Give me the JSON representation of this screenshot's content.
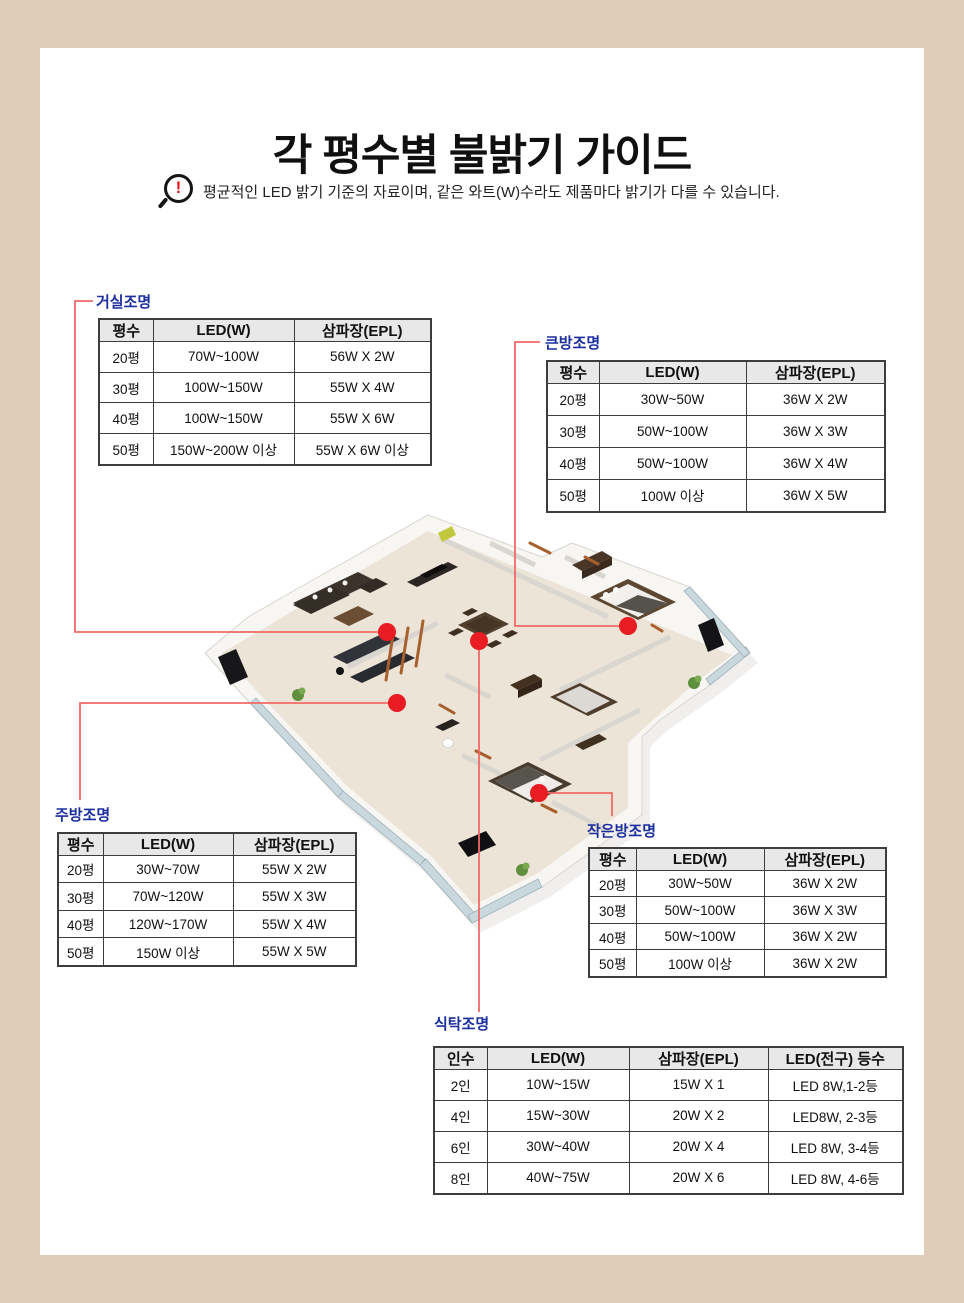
{
  "page": {
    "title": "각 평수별 불밝기 가이드",
    "notice": "평균적인 LED 밝기 기준의 자료이며, 같은 와트(W)수라도 제품마다 밝기가 다를 수 있습니다.",
    "notice_icon": "magnifier-exclamation-icon"
  },
  "colors": {
    "background": "#e0ccb8",
    "panel": "#ffffff",
    "label_blue": "#1c2f9f",
    "connector_red": "#f26a66",
    "dot_red": "#ea1c23",
    "table_header_bg": "#e8e8e8",
    "table_border": "#3d3d3d"
  },
  "tables": [
    {
      "id": "living",
      "label": "거실조명",
      "headers": [
        "평수",
        "LED(W)",
        "삼파장(EPL)"
      ],
      "rows": [
        [
          "20평",
          "70W~100W",
          "56W X 2W"
        ],
        [
          "30평",
          "100W~150W",
          "55W X 4W"
        ],
        [
          "40평",
          "100W~150W",
          "55W X 6W"
        ],
        [
          "50평",
          "150W~200W 이상",
          "55W X 6W 이상"
        ]
      ]
    },
    {
      "id": "bigroom",
      "label": "큰방조명",
      "headers": [
        "평수",
        "LED(W)",
        "삼파장(EPL)"
      ],
      "rows": [
        [
          "20평",
          "30W~50W",
          "36W X 2W"
        ],
        [
          "30평",
          "50W~100W",
          "36W X 3W"
        ],
        [
          "40평",
          "50W~100W",
          "36W X 4W"
        ],
        [
          "50평",
          "100W 이상",
          "36W X 5W"
        ]
      ]
    },
    {
      "id": "kitchen",
      "label": "주방조명",
      "headers": [
        "평수",
        "LED(W)",
        "삼파장(EPL)"
      ],
      "rows": [
        [
          "20평",
          "30W~70W",
          "55W X 2W"
        ],
        [
          "30평",
          "70W~120W",
          "55W X 3W"
        ],
        [
          "40평",
          "120W~170W",
          "55W X 4W"
        ],
        [
          "50평",
          "150W 이상",
          "55W X 5W"
        ]
      ]
    },
    {
      "id": "smallroom",
      "label": "작은방조명",
      "headers": [
        "평수",
        "LED(W)",
        "삼파장(EPL)"
      ],
      "rows": [
        [
          "20평",
          "30W~50W",
          "36W X 2W"
        ],
        [
          "30평",
          "50W~100W",
          "36W X 3W"
        ],
        [
          "40평",
          "50W~100W",
          "36W X 2W"
        ],
        [
          "50평",
          "100W 이상",
          "36W X 2W"
        ]
      ]
    },
    {
      "id": "dining",
      "label": "식탁조명",
      "headers": [
        "인수",
        "LED(W)",
        "삼파장(EPL)",
        "LED(전구) 등수"
      ],
      "rows": [
        [
          "2인",
          "10W~15W",
          "15W X 1",
          "LED 8W,1-2등"
        ],
        [
          "4인",
          "15W~30W",
          "20W X 2",
          "LED8W, 2-3등"
        ],
        [
          "6인",
          "30W~40W",
          "20W X 4",
          "LED 8W, 3-4등"
        ],
        [
          "8인",
          "40W~75W",
          "20W X 6",
          "LED 8W, 4-6등"
        ]
      ]
    }
  ]
}
